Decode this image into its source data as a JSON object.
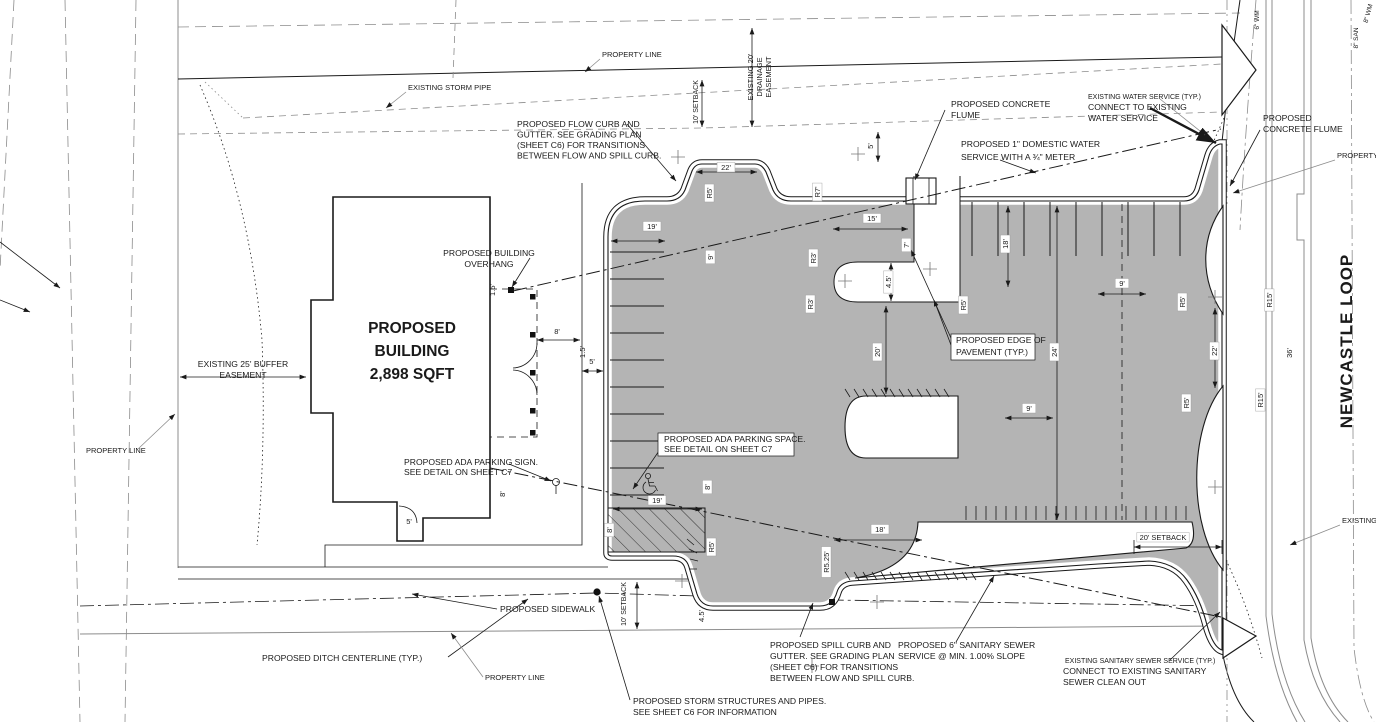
{
  "colors": {
    "pavement": "#b4b4b4",
    "ink": "#1a1a1a",
    "muted": "#8c8c8c"
  },
  "street": {
    "name": "NEWCASTLE LOOP"
  },
  "building": {
    "name_lines": [
      "PROPOSED",
      "BUILDING",
      "2,898 SQFT"
    ]
  },
  "annotations": [
    {
      "id": "property-line-top",
      "lines": [
        "PROPERTY LINE"
      ],
      "x": 602,
      "y": 57,
      "cls": "gray",
      "size": 7.5
    },
    {
      "id": "existing-storm-pipe-label",
      "lines": [
        "EXISTING STORM PIPE"
      ],
      "x": 408,
      "y": 90,
      "cls": "gray",
      "size": 7.5
    },
    {
      "id": "flow-curb-note",
      "lines": [
        "PROPOSED FLOW CURB AND",
        "GUTTER. SEE GRADING PLAN",
        "(SHEET C6) FOR TRANSITIONS",
        "BETWEEN FLOW AND SPILL CURB."
      ],
      "x": 517,
      "y": 127,
      "lh": 10.5
    },
    {
      "id": "concrete-flume-note-mid",
      "lines": [
        "PROPOSED CONCRETE",
        "FLUME"
      ],
      "x": 951,
      "y": 107,
      "lh": 11
    },
    {
      "id": "existing-water-service-label",
      "lines": [
        "EXISTING WATER SERVICE (TYP.)"
      ],
      "x": 1088,
      "y": 99,
      "cls": "gray",
      "size": 7
    },
    {
      "id": "connect-water-note",
      "lines": [
        "CONNECT TO EXISTING",
        "WATER SERVICE"
      ],
      "x": 1088,
      "y": 110,
      "lh": 11
    },
    {
      "id": "domestic-water-note",
      "lines": [
        "PROPOSED 1\" DOMESTIC WATER",
        "SERVICE WITH A ¾\" METER"
      ],
      "x": 961,
      "y": 147,
      "lh": 13
    },
    {
      "id": "concrete-flume-note-right",
      "lines": [
        "PROPOSED",
        "CONCRETE FLUME"
      ],
      "x": 1263,
      "y": 121,
      "lh": 11
    },
    {
      "id": "property-line-right",
      "lines": [
        "PROPERTY LINE"
      ],
      "x": 1337,
      "y": 158,
      "cls": "gray",
      "size": 7.5
    },
    {
      "id": "overhang-note",
      "lines": [
        "PROPOSED BUILDING",
        "OVERHANG"
      ],
      "x": 489,
      "y": 256,
      "anchor": "middle",
      "lh": 11
    },
    {
      "id": "building-label",
      "lines": [
        "PROPOSED",
        "BUILDING",
        "2,898 SQFT"
      ],
      "x": 412,
      "y": 333,
      "anchor": "middle",
      "size": 15.5,
      "lh": 23,
      "weight": 700
    },
    {
      "id": "buffer-easement-note",
      "lines": [
        "EXISTING 25' BUFFER",
        "EASEMENT"
      ],
      "x": 243,
      "y": 367,
      "anchor": "middle",
      "lh": 11
    },
    {
      "id": "property-line-left",
      "lines": [
        "PROPERTY LINE"
      ],
      "x": 86,
      "y": 453,
      "cls": "gray",
      "size": 7.5
    },
    {
      "id": "edge-of-pavement-note",
      "lines": [
        "PROPOSED EDGE OF",
        "PAVEMENT (TYP.)"
      ],
      "x": 956,
      "y": 343,
      "lh": 12,
      "bg": [
        951,
        334,
        84,
        26
      ]
    },
    {
      "id": "ada-sign-note",
      "lines": [
        "PROPOSED ADA PARKING SIGN.",
        "SEE DETAIL ON SHEET C7"
      ],
      "x": 404,
      "y": 465,
      "lh": 10
    },
    {
      "id": "ada-space-note",
      "lines": [
        "PROPOSED ADA PARKING SPACE.",
        "SEE DETAIL ON SHEET C7"
      ],
      "x": 664,
      "y": 442,
      "lh": 10,
      "bg": [
        658,
        433,
        136,
        23
      ]
    },
    {
      "id": "sidewalk-note",
      "lines": [
        "PROPOSED SIDEWALK"
      ],
      "x": 500,
      "y": 612
    },
    {
      "id": "ditch-note",
      "lines": [
        "PROPOSED DITCH CENTERLINE (TYP.)"
      ],
      "x": 262,
      "y": 661
    },
    {
      "id": "property-line-bottom",
      "lines": [
        "PROPERTY LINE"
      ],
      "x": 485,
      "y": 680,
      "cls": "gray",
      "size": 7.5
    },
    {
      "id": "storm-structures-note",
      "lines": [
        "PROPOSED STORM STRUCTURES AND PIPES.",
        "SEE SHEET C6 FOR INFORMATION"
      ],
      "x": 633,
      "y": 704,
      "lh": 11
    },
    {
      "id": "spill-curb-note",
      "lines": [
        "PROPOSED SPILL CURB AND",
        "GUTTER. SEE GRADING PLAN",
        "(SHEET C6) FOR TRANSITIONS",
        "BETWEEN FLOW AND SPILL CURB."
      ],
      "x": 770,
      "y": 648,
      "lh": 11
    },
    {
      "id": "sanitary-sewer-note",
      "lines": [
        "PROPOSED 6\" SANITARY SEWER",
        "SERVICE @ MIN. 1.00% SLOPE"
      ],
      "x": 898,
      "y": 648,
      "lh": 11
    },
    {
      "id": "existing-sanitary-label",
      "lines": [
        "EXISTING SANITARY SEWER SERVICE (TYP.)"
      ],
      "x": 1065,
      "y": 663,
      "cls": "gray",
      "size": 7
    },
    {
      "id": "connect-sanitary-note",
      "lines": [
        "CONNECT TO EXISTING SANITARY",
        "SEWER CLEAN OUT"
      ],
      "x": 1063,
      "y": 674,
      "lh": 11
    },
    {
      "id": "existing-curb-label",
      "lines": [
        "EXISTING CURB"
      ],
      "x": 1342,
      "y": 523,
      "cls": "gray",
      "size": 7.5
    },
    {
      "id": "drainage-easement-label",
      "lines": [
        "EXISTING 20'",
        "DRAINAGE",
        "EASEMENT"
      ],
      "x": 753,
      "y": 77,
      "rot": -90,
      "anchor": "middle",
      "lh": 9,
      "size": 7.5
    },
    {
      "id": "setback-10-top-label",
      "lines": [
        "10' SETBACK"
      ],
      "x": 698,
      "y": 102,
      "rot": -90,
      "anchor": "middle",
      "size": 7
    },
    {
      "id": "setback-10-bottom-label",
      "lines": [
        "10' SETBACK"
      ],
      "x": 626,
      "y": 604,
      "rot": -90,
      "anchor": "middle",
      "size": 7
    },
    {
      "id": "wm-6-label",
      "lines": [
        "6\" WM"
      ],
      "x": 1259,
      "y": 20,
      "rot": -90,
      "anchor": "middle",
      "cls": "gray",
      "size": 6.5
    },
    {
      "id": "san-8-label",
      "lines": [
        "8\" SAN"
      ],
      "x": 1358,
      "y": 38,
      "rot": -90,
      "anchor": "middle",
      "cls": "gray",
      "size": 6.5
    },
    {
      "id": "wm-8-corner-label",
      "lines": [
        "8\" WM"
      ],
      "x": 1370,
      "y": 14,
      "rot": -75,
      "anchor": "middle",
      "cls": "gray",
      "size": 6.5
    },
    {
      "id": "street-name",
      "lines": [
        "NEWCASTLE LOOP"
      ],
      "x": 1352,
      "y": 341,
      "rot": -90,
      "anchor": "middle",
      "size": 17,
      "weight": 700,
      "ls": 1
    }
  ],
  "dims": [
    {
      "t": "22'",
      "x": 726,
      "y": 170,
      "bg": 1
    },
    {
      "t": "5'",
      "x": 873,
      "y": 146,
      "rot": 1
    },
    {
      "t": "19'",
      "x": 652,
      "y": 229,
      "bg": 1
    },
    {
      "t": "9'",
      "x": 713,
      "y": 257,
      "rot": 1,
      "bg": 1
    },
    {
      "t": "15'",
      "x": 872,
      "y": 221,
      "bg": 1
    },
    {
      "t": "7'",
      "x": 909,
      "y": 245,
      "rot": 1,
      "bg": 1
    },
    {
      "t": "4.5'",
      "x": 891,
      "y": 282,
      "rot": 1,
      "bg": 1
    },
    {
      "t": "20'",
      "x": 880,
      "y": 352,
      "rot": 1,
      "bg": 1
    },
    {
      "t": "5'",
      "x": 592,
      "y": 364
    },
    {
      "t": "8'",
      "x": 557,
      "y": 334
    },
    {
      "t": "1.5'",
      "x": 495,
      "y": 290,
      "rot": 1
    },
    {
      "t": "1.5'",
      "x": 585,
      "y": 352,
      "rot": 1
    },
    {
      "t": "5'",
      "x": 409,
      "y": 524
    },
    {
      "t": "8'",
      "x": 505,
      "y": 494,
      "rot": 1
    },
    {
      "t": "19'",
      "x": 657,
      "y": 503,
      "bg": 1
    },
    {
      "t": "8'",
      "x": 612,
      "y": 530,
      "rot": 1,
      "bg": 1
    },
    {
      "t": "8'",
      "x": 710,
      "y": 487,
      "rot": 1,
      "bg": 1
    },
    {
      "t": "R5'",
      "x": 714,
      "y": 547,
      "rot": 1,
      "bg": 1
    },
    {
      "t": "R5.25'",
      "x": 829,
      "y": 562,
      "rot": 1,
      "bg": 1
    },
    {
      "t": "18'",
      "x": 880,
      "y": 532,
      "bg": 1
    },
    {
      "t": "4.5'",
      "x": 704,
      "y": 616,
      "rot": 1
    },
    {
      "t": "18'",
      "x": 1008,
      "y": 244,
      "rot": 1,
      "bg": 1
    },
    {
      "t": "24'",
      "x": 1057,
      "y": 352,
      "rot": 1,
      "bg": 1
    },
    {
      "t": "9'",
      "x": 1122,
      "y": 286,
      "bg": 1
    },
    {
      "t": "9'",
      "x": 1029,
      "y": 411,
      "bg": 1
    },
    {
      "t": "22'",
      "x": 1217,
      "y": 351,
      "rot": 1,
      "bg": 1
    },
    {
      "t": "36'",
      "x": 1292,
      "y": 353,
      "rot": 1
    },
    {
      "t": "R5'",
      "x": 712,
      "y": 193,
      "rot": 1,
      "bg": 1
    },
    {
      "t": "R7'",
      "x": 820,
      "y": 192,
      "rot": 1,
      "bg": 1
    },
    {
      "t": "R3'",
      "x": 816,
      "y": 258,
      "rot": 1,
      "bg": 1
    },
    {
      "t": "R3'",
      "x": 813,
      "y": 304,
      "rot": 1,
      "bg": 1
    },
    {
      "t": "R5'",
      "x": 966,
      "y": 305,
      "rot": 1,
      "bg": 1
    },
    {
      "t": "R5'",
      "x": 1185,
      "y": 302,
      "rot": 1,
      "bg": 1
    },
    {
      "t": "R15'",
      "x": 1272,
      "y": 300,
      "rot": 1,
      "bg": 1
    },
    {
      "t": "R5'",
      "x": 1189,
      "y": 403,
      "rot": 1,
      "bg": 1
    },
    {
      "t": "R15'",
      "x": 1263,
      "y": 400,
      "rot": 1,
      "bg": 1
    },
    {
      "t": "20' SETBACK",
      "x": 1163,
      "y": 540,
      "bg": 1
    }
  ]
}
